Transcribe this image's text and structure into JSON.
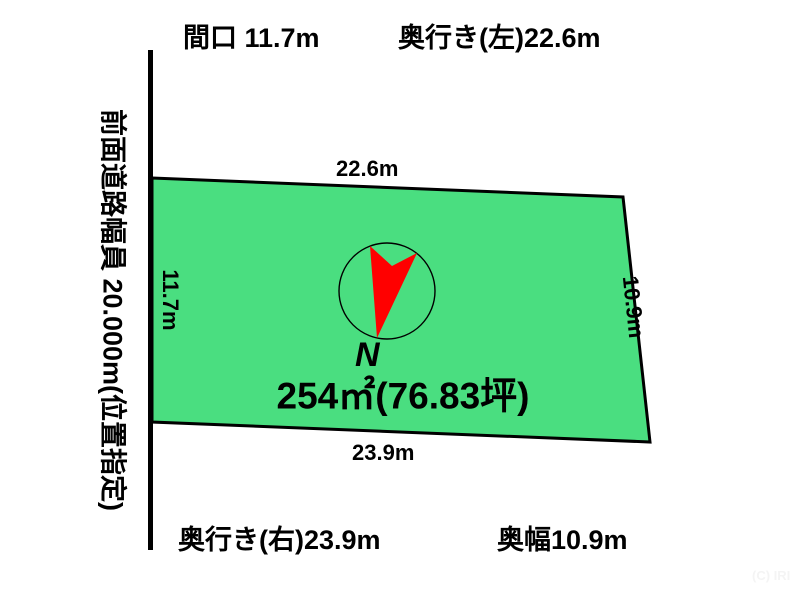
{
  "header": {
    "frontage_label": "間口 11.7m",
    "depth_left_label": "奥行き(左)22.6m"
  },
  "footer": {
    "depth_right_label": "奥行き(右)23.9m",
    "back_width_label": "奥幅10.9m"
  },
  "road": {
    "label": "前面道路幅員 20.000m(位置指定)"
  },
  "plot": {
    "area_label": "254㎡(76.83坪)",
    "north_letter": "N",
    "edge_top": "22.6m",
    "edge_left": "11.7m",
    "edge_right": "10.9m",
    "edge_bottom": "23.9m"
  },
  "watermark": "(C) IRI",
  "colors": {
    "plot_fill": "#4ade80",
    "plot_stroke": "#000000",
    "road_line": "#000000",
    "north_arrow": "#ff0000",
    "compass_stroke": "#000000",
    "watermark_text": "#f4f4f4"
  }
}
